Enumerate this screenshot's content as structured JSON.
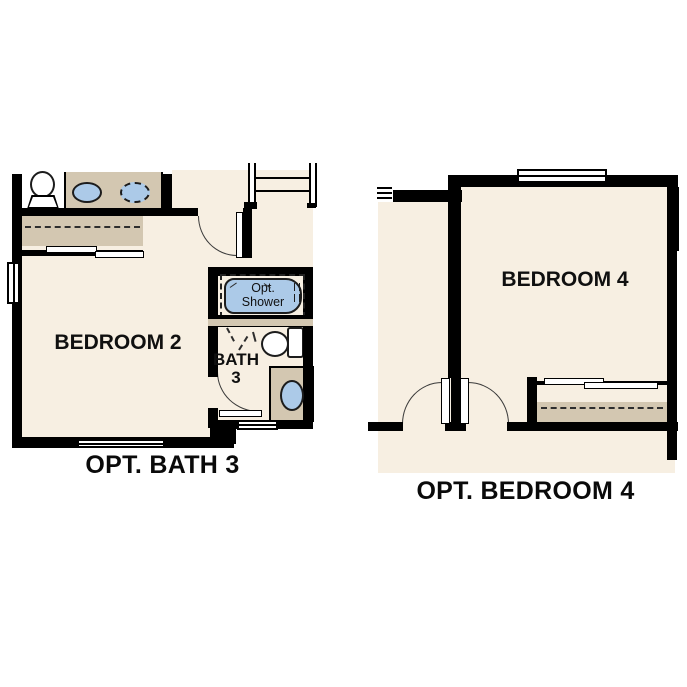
{
  "colors": {
    "wall": "#000000",
    "line": "#3a3a3a",
    "floor": "#f7efe2",
    "fixture_tan": "#d3c7b1",
    "fixture_blue": "#accae8",
    "text": "#101010"
  },
  "plans": {
    "left": {
      "caption": "OPT. BATH 3",
      "labels": {
        "bedroom": "BEDROOM 2",
        "bath_line1": "BATH",
        "bath_line2": "3",
        "shower_line1": "Opt.",
        "shower_line2": "Shower"
      }
    },
    "right": {
      "caption": "OPT. BEDROOM 4",
      "labels": {
        "bedroom": "BEDROOM 4"
      }
    }
  }
}
